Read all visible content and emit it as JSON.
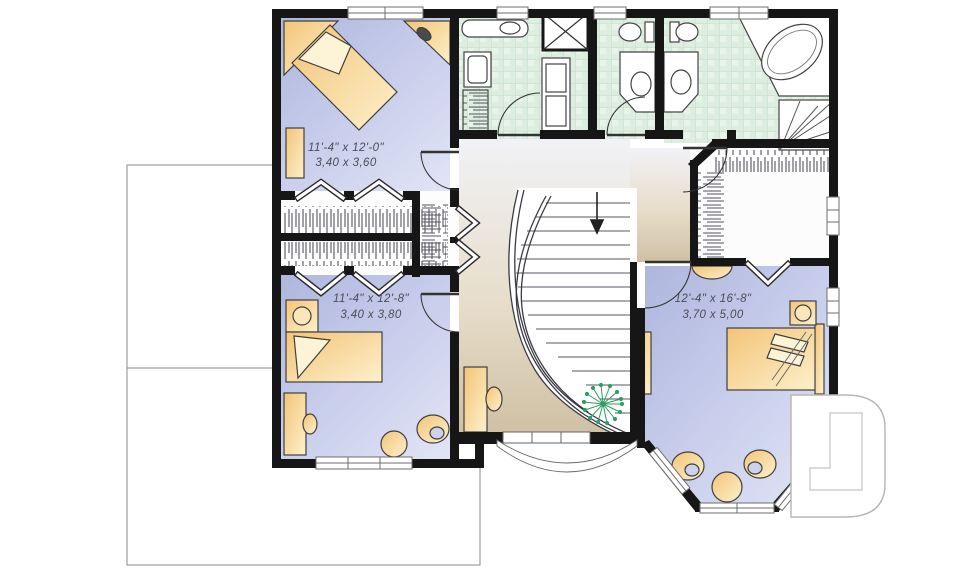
{
  "plan": {
    "type": "second-floor-plan",
    "rooms": [
      {
        "id": "bedroom-1",
        "imperial": "11'-4\" x 12'-0\"",
        "metric": "3,40 x 3,60"
      },
      {
        "id": "bedroom-2",
        "imperial": "11'-4\" x 12'-8\"",
        "metric": "3,40 x 3,80"
      },
      {
        "id": "master-bedroom",
        "imperial": "12'-4\" x 16'-8\"",
        "metric": "3,70 x 5,00"
      }
    ],
    "stair_direction": "down",
    "logo": {
      "letter": "D"
    },
    "colors": {
      "walls": "#161616",
      "bedroom_floor": "#bcc3e5",
      "bath_tile": "#ddeee1",
      "hall_floor": "#d5c7ae",
      "furniture": "#f6cf8a",
      "plant": "#2f9e62",
      "outline": "#8a8a8a",
      "label_text": "#4c4c58"
    }
  }
}
